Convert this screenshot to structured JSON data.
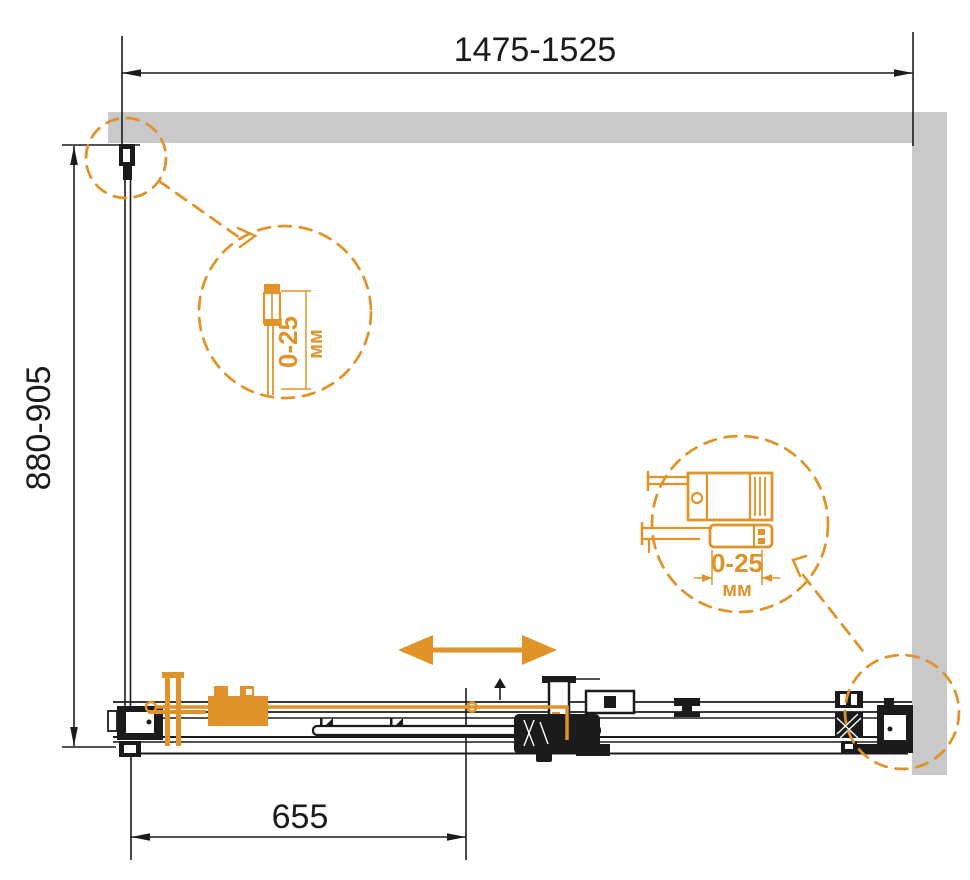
{
  "dimensions": {
    "width_range": "1475-1525",
    "height_range": "880-905",
    "door_offset": "655"
  },
  "callouts": {
    "wall_profile": {
      "value": "0-25",
      "unit": "мм"
    },
    "door_rail": {
      "value": "0-25",
      "unit": "мм"
    }
  },
  "colors": {
    "accent": "#df9329",
    "wall": "#c9c9c9",
    "line": "#1b1b1b"
  }
}
